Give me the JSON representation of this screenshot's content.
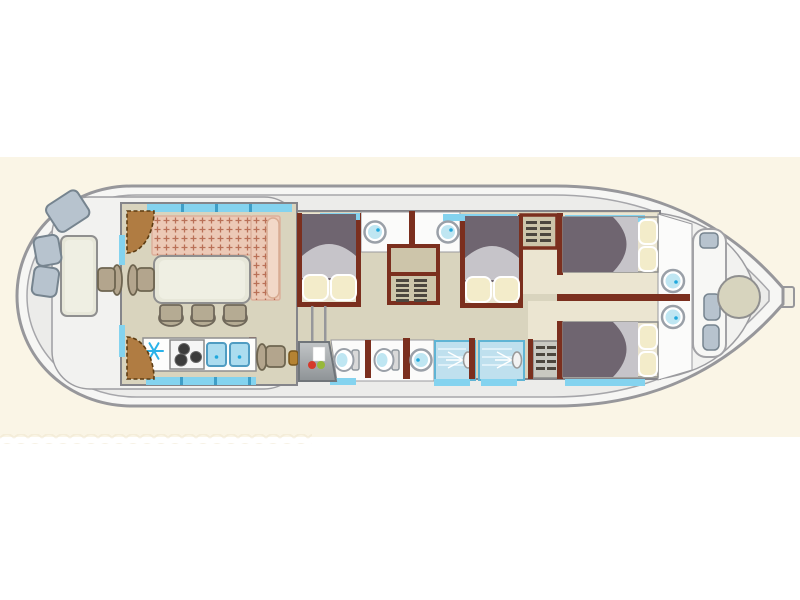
{
  "meta": {
    "type": "houseboat-deck-plan",
    "orientation": "bow-right-stern-left",
    "text_visible": ""
  },
  "colors": {
    "band": "#faf5e6",
    "hull_fill": "#f6f6f4",
    "hull_stroke": "#97979b",
    "deck": "#ececea",
    "well": "#f2f2f0",
    "floor": "#d9d4be",
    "room_floor": "#ebe5d1",
    "white_floor": "#fbfbfa",
    "wall": "#85858a",
    "wall_brown": "#7b2f1e",
    "window": "#84d3ef",
    "window_frame": "#3e9ec7",
    "sofa": "#ecc9b6",
    "sofa_dot": "#b06047",
    "sofa_bolster": "#f2d8c8",
    "table": "#e7e7d9",
    "stool": "#b5ab93",
    "stool_edge": "#70685a",
    "seat_blue": "#b7c3ce",
    "seat_blue_edge": "#76848f",
    "blanket": "#6f6570",
    "sheet": "#c6c4c9",
    "pillow": "#f3ecca",
    "wardrobe": "#cdc5aa",
    "slat": "#4c463e",
    "shower": "#bfe0ee",
    "shower_edge": "#5fb4d4",
    "basin": "#bfe6f2",
    "fixture_ring": "#9aa0a8",
    "tan": "#b3a58d",
    "tan_edge": "#6e6550",
    "wood": "#b07c42",
    "wood_edge": "#5d3c12",
    "counter": "#fdfdfc",
    "snowflake": "#29b2e9",
    "red": "#d5392b",
    "green": "#97b83a",
    "bow_table": "#d7d4be"
  },
  "plan": {
    "zones": [
      {
        "name": "stern-deck",
        "items": [
          "deck-table",
          "bench-cushion",
          "bench-cushion",
          "bench-cushion",
          "exterior-helm-chair",
          "entry-double-door"
        ]
      },
      {
        "name": "saloon",
        "items": [
          "l-shaped-sofa",
          "sofa-bolster",
          "dining-table",
          "dining-chair",
          "stool",
          "stool",
          "stool"
        ]
      },
      {
        "name": "galley",
        "items": [
          "fridge-freezer",
          "hob-3-burner",
          "double-sink",
          "counter",
          "bar-divider"
        ]
      },
      {
        "name": "helm-station",
        "items": [
          "helm-console",
          "steering-wheel",
          "helm-chair",
          "sliding-door-track"
        ]
      },
      {
        "name": "cabin-midship-port",
        "items": [
          "double-bed",
          "pillow",
          "pillow"
        ]
      },
      {
        "name": "bathroom-1",
        "items": [
          "washbasin"
        ]
      },
      {
        "name": "bathroom-2",
        "items": [
          "washbasin"
        ]
      },
      {
        "name": "wardrobe-midship",
        "items": [
          "shelves",
          "slatted-locker"
        ]
      },
      {
        "name": "cabin-midship-starboard",
        "items": [
          "double-bed",
          "pillow",
          "pillow"
        ]
      },
      {
        "name": "wc-1",
        "items": [
          "toilet"
        ]
      },
      {
        "name": "wc-2",
        "items": [
          "toilet",
          "washbasin"
        ]
      },
      {
        "name": "shower-1",
        "items": [
          "shower-head"
        ]
      },
      {
        "name": "shower-2",
        "items": [
          "shower-head"
        ]
      },
      {
        "name": "wardrobe-aft-cabin",
        "items": [
          "slatted-locker"
        ]
      },
      {
        "name": "cabin-bow-port",
        "items": [
          "double-bed",
          "pillow",
          "pillow",
          "washbasin",
          "wardrobe"
        ]
      },
      {
        "name": "cabin-bow-starboard",
        "items": [
          "double-bed",
          "pillow",
          "pillow",
          "washbasin"
        ]
      },
      {
        "name": "bow-deck",
        "items": [
          "bench-seat",
          "cushion",
          "cushion",
          "cushion",
          "round-table",
          "bow-platform"
        ]
      }
    ],
    "window_segments": 12,
    "cabin_count": 4,
    "shower_count": 2,
    "toilet_count": 2,
    "washbasin_count": 5
  }
}
